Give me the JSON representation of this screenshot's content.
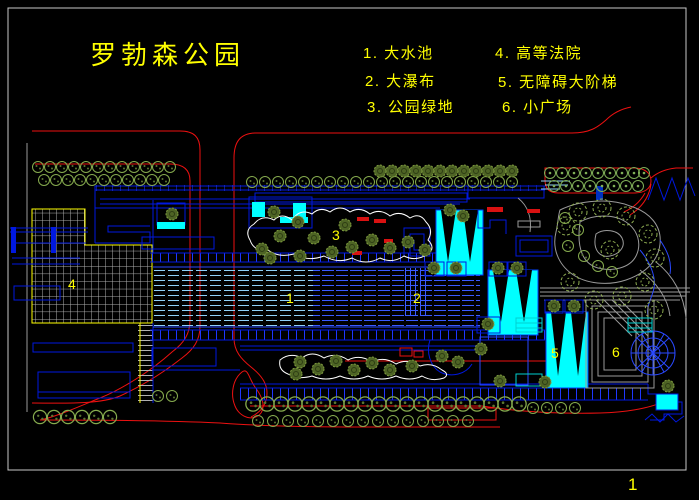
{
  "title": "罗勃森公园",
  "legend": {
    "col1": [
      "1. 大水池",
      "2. 大瀑布",
      "3. 公园绿地"
    ],
    "col2": [
      "4. 高等法院",
      "5. 无障碍大阶梯",
      "6. 小广场"
    ]
  },
  "markers": [
    "1",
    "2",
    "3",
    "4",
    "5",
    "6"
  ],
  "page_number": "1",
  "features": {
    "1": "大水池",
    "2": "大瀑布",
    "3": "公园绿地",
    "4": "高等法院",
    "5": "无障碍大阶梯",
    "6": "小广场"
  },
  "colors": {
    "background": "#000000",
    "frame_gray": "#c8c8c8",
    "text_yellow": "#ffff00",
    "road_red": "#ee1111",
    "structure_blue": "#0018e0",
    "water_cyan": "#00ffff",
    "water_light_blue": "#8fd0f8",
    "water_royal_blue": "#3a5bff",
    "tree_green": "#86ab4e",
    "bush_olive": "#4e6425",
    "contour_gray": "#9a9a9a",
    "outline_white": "#ffffff"
  }
}
